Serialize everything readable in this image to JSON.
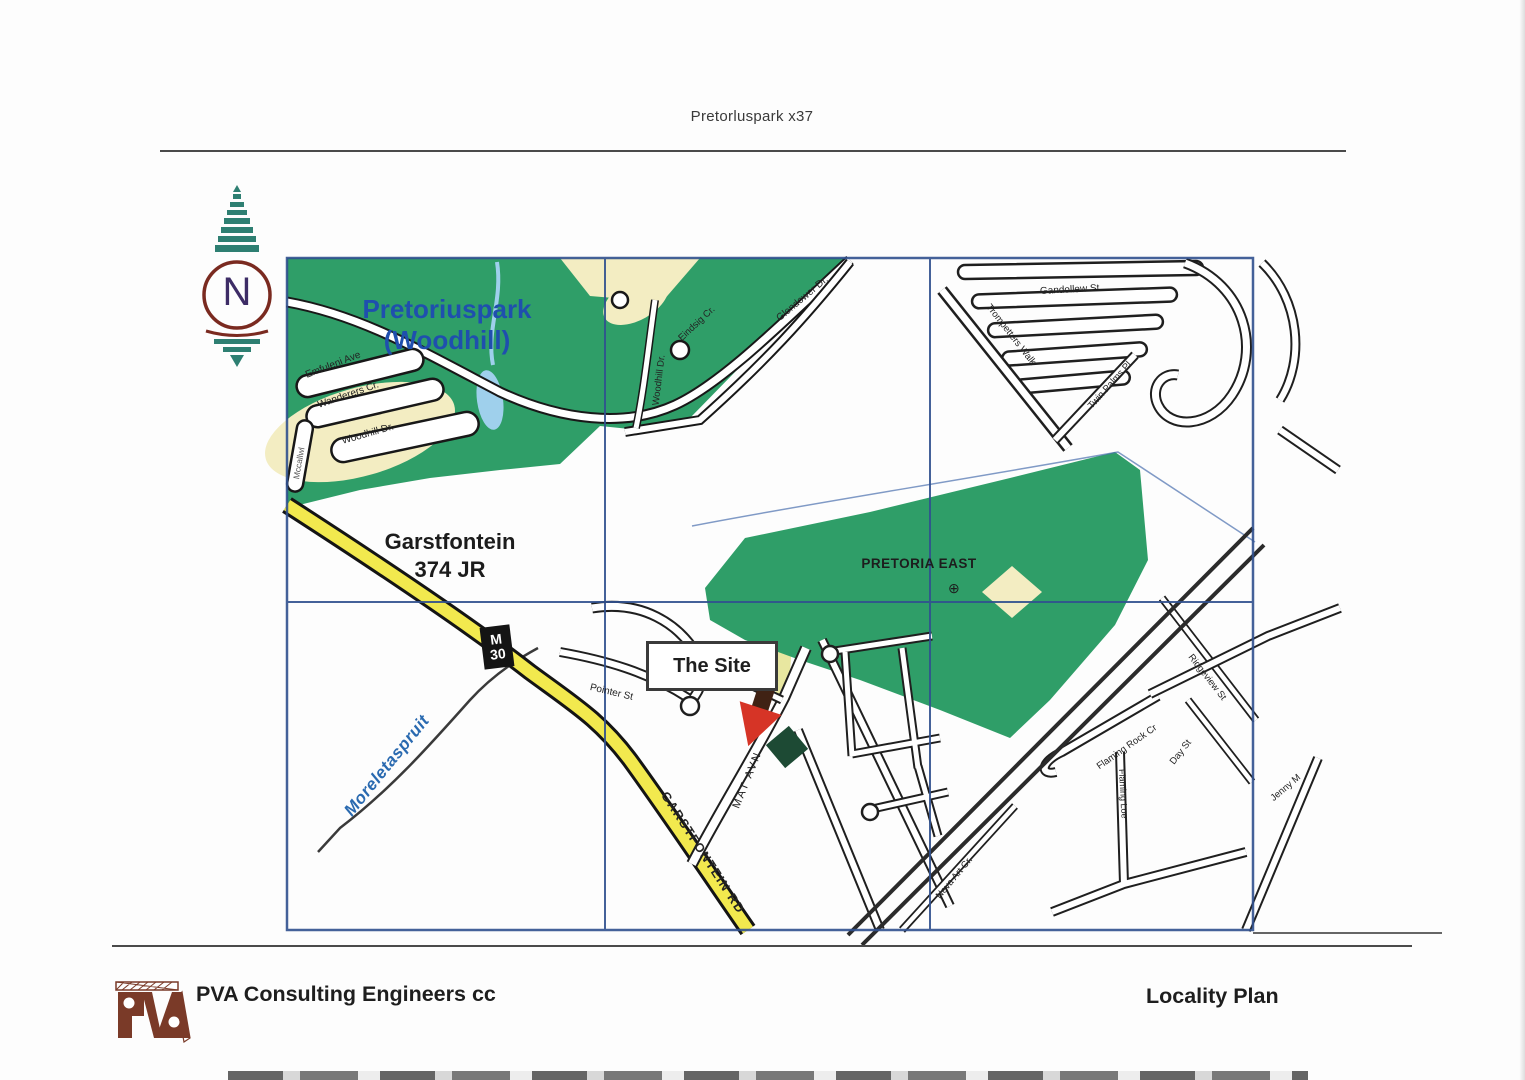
{
  "doc": {
    "header_title": "Pretorluspark x37",
    "company": "PVA Consulting Engineers cc",
    "plan_title": "Locality Plan",
    "logo_text": "PVA"
  },
  "compass": {
    "letter": "N"
  },
  "map": {
    "suburb_line1": "Pretoriuspark",
    "suburb_line2": "(Woodhill)",
    "farm_line1": "Garstfontein",
    "farm_line2": "374 JR",
    "area_label": "PRETORIA EAST",
    "area_symbol": "⊕",
    "river_label": "Moreletaspruit",
    "site_label": "The Site",
    "badge_m": "M",
    "badge_30": "30",
    "main_road_label": "GARSTFONTEIN RD",
    "streets": [
      {
        "label": "Emfuleni Ave"
      },
      {
        "label": "Wanderers Cr."
      },
      {
        "label": "Woodhill Dr."
      },
      {
        "label": "Woodhill Dr."
      },
      {
        "label": "Eindsig Cr."
      },
      {
        "label": "Glendower Dr."
      },
      {
        "label": "Gandollew St"
      },
      {
        "label": "Trompetters Walk"
      },
      {
        "label": "Twin Palms Pl."
      },
      {
        "label": "Pointer St"
      },
      {
        "label": "MAT AVN"
      },
      {
        "label": "Ridgeview St"
      },
      {
        "label": "Flaming Rock Cr"
      },
      {
        "label": "Day St"
      },
      {
        "label": "Flaming Loe"
      },
      {
        "label": "Jenny M"
      },
      {
        "label": "Neva Art Cr."
      },
      {
        "label": "Mccallwl"
      }
    ]
  },
  "colors": {
    "map_green": "#2f9e68",
    "cream": "#f3edc2",
    "road_yellow": "#f2e94e",
    "grid_blue": "#31518f",
    "suburb_blue": "#1f4fae",
    "river_blue": "#2a6ab0",
    "arrow_red": "#d63426",
    "site_green": "#1d4a34",
    "logo_brown": "#7a3a28"
  }
}
